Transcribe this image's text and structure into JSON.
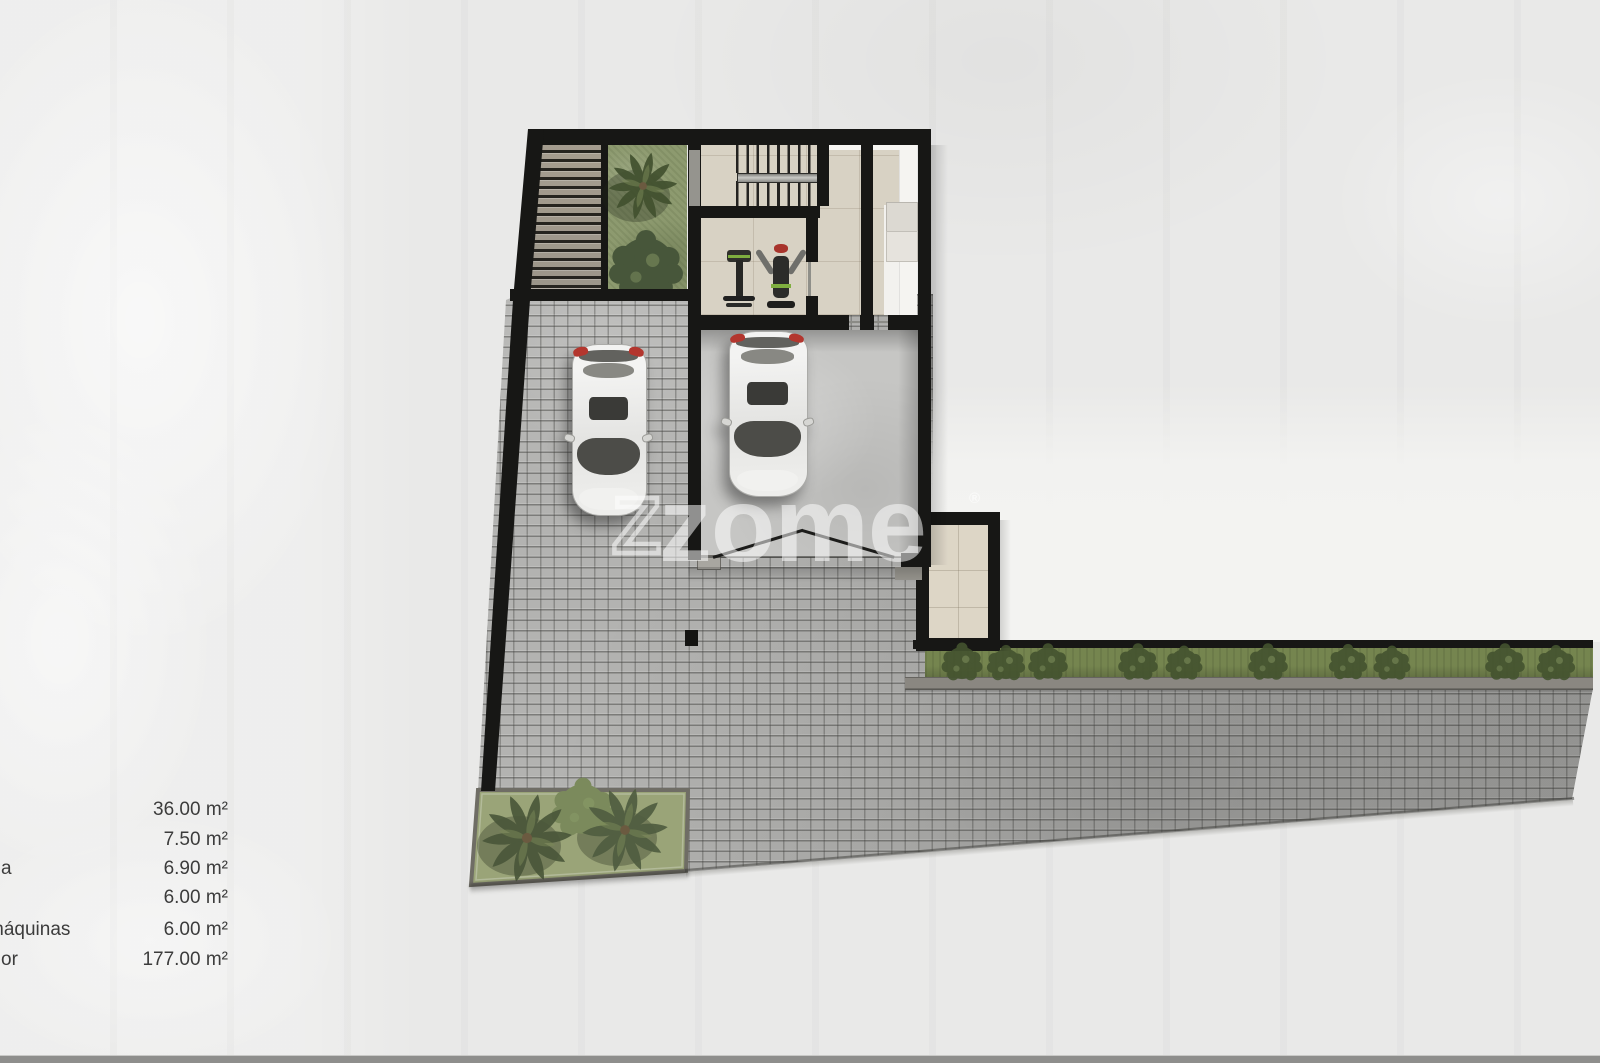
{
  "watermark": {
    "mark": "Z",
    "word": "zome",
    "registered": "®"
  },
  "legend": {
    "rows": [
      {
        "label": "",
        "value": "36.00 m²"
      },
      {
        "label": "",
        "value": "7.50 m²"
      },
      {
        "label": "a",
        "value": "6.90 m²"
      },
      {
        "label": "",
        "value": "6.00 m²"
      },
      {
        "label": "máquinas",
        "value": "6.00 m²"
      },
      {
        "label": "or",
        "value": "177.00 m²"
      }
    ]
  },
  "colors": {
    "wall": "#171715",
    "paper": "#e9e9e8",
    "cobble": "#b3b3b1",
    "garage-floor": "#c6c6c4",
    "tile": "#d8d2c4",
    "grass": "#8d9a6f",
    "bed-grass": "#9aa478",
    "hedge": "#75854f",
    "curb": "#8a8781",
    "white-area": "#f3f3f1",
    "taillight": "#b3362e",
    "legend-text": "#3c3c3c",
    "watermark": "rgba(255,255,255,0.52)",
    "bottom-band": "#8e8e8c"
  }
}
